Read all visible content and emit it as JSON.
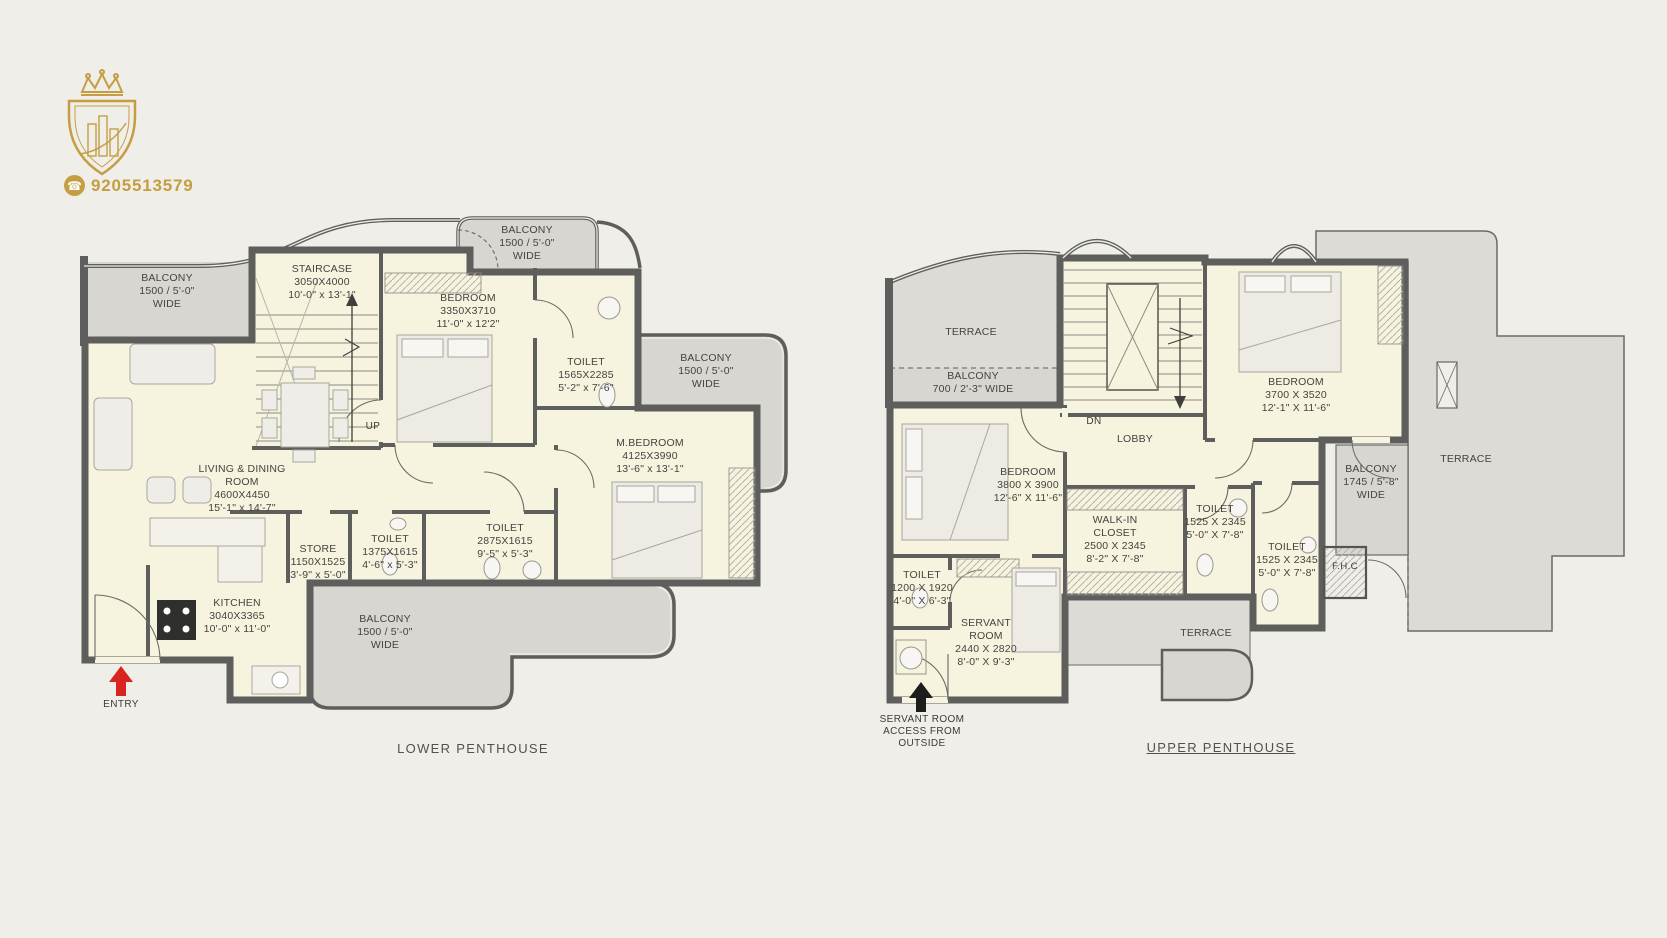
{
  "brand": {
    "phone": "9205513579",
    "phone_icon": "☎",
    "logo_name": "gold-crown-shield-buildings",
    "gold": "#c59d43"
  },
  "colors": {
    "background": "#efeee9",
    "room_fill": "#f6f3df",
    "balcony_fill": "#d7d6d1",
    "terrace_fill": "#dcdbd6",
    "wall": "#5e5e5c",
    "entry_arrow_red": "#d8251f",
    "label_text": "#45443f"
  },
  "lower_penthouse": {
    "title": "LOWER PENTHOUSE",
    "up_label": "UP",
    "entry_label": "ENTRY",
    "rooms": [
      {
        "id": "balcony-top-left",
        "lines": [
          "BALCONY",
          "1500 / 5'-0\"",
          "WIDE"
        ]
      },
      {
        "id": "staircase",
        "lines": [
          "STAIRCASE",
          "3050X4000",
          "10'-0\" x 13'-1\""
        ]
      },
      {
        "id": "bedroom",
        "lines": [
          "BEDROOM",
          "3350X3710",
          "11'-0\" x 12'2\""
        ]
      },
      {
        "id": "balcony-top",
        "lines": [
          "BALCONY",
          "1500 / 5'-0\"",
          "WIDE"
        ]
      },
      {
        "id": "toilet-1",
        "lines": [
          "TOILET",
          "1565X2285",
          "5'-2\" x 7'-6\""
        ]
      },
      {
        "id": "balcony-right",
        "lines": [
          "BALCONY",
          "1500 / 5'-0\"",
          "WIDE"
        ]
      },
      {
        "id": "master-bedroom",
        "lines": [
          "M.BEDROOM",
          "4125X3990",
          "13'-6\" x 13'-1\""
        ]
      },
      {
        "id": "living-dining",
        "lines": [
          "LIVING & DINING",
          "ROOM",
          "4600X4450",
          "15'-1\" x 14'-7\""
        ]
      },
      {
        "id": "store",
        "lines": [
          "STORE",
          "1150X1525",
          "3'-9\" x 5'-0\""
        ]
      },
      {
        "id": "toilet-2",
        "lines": [
          "TOILET",
          "1375X1615",
          "4'-6\" x 5'-3\""
        ]
      },
      {
        "id": "toilet-3",
        "lines": [
          "TOILET",
          "2875X1615",
          "9'-5\" x 5'-3\""
        ]
      },
      {
        "id": "kitchen",
        "lines": [
          "KITCHEN",
          "3040X3365",
          "10'-0\" x 11'-0\""
        ]
      },
      {
        "id": "balcony-bottom",
        "lines": [
          "BALCONY",
          "1500 / 5'-0\"",
          "WIDE"
        ]
      }
    ]
  },
  "upper_penthouse": {
    "title": "UPPER PENTHOUSE",
    "dn_label": "DN",
    "fhc_label": "F.H.C",
    "access_note": [
      "SERVANT ROOM",
      "ACCESS FROM",
      "OUTSIDE"
    ],
    "rooms": [
      {
        "id": "terrace-top-left",
        "lines": [
          "TERRACE"
        ]
      },
      {
        "id": "balcony-top",
        "lines": [
          "BALCONY",
          "700 / 2'-3\" WIDE"
        ]
      },
      {
        "id": "lobby",
        "lines": [
          "LOBBY"
        ]
      },
      {
        "id": "bedroom-right",
        "lines": [
          "BEDROOM",
          "3700 X 3520",
          "12'-1\" X 11'-6\""
        ]
      },
      {
        "id": "terrace-right",
        "lines": [
          "TERRACE"
        ]
      },
      {
        "id": "balcony-right",
        "lines": [
          "BALCONY",
          "1745 / 5'-8\"",
          "WIDE"
        ]
      },
      {
        "id": "bedroom-left",
        "lines": [
          "BEDROOM",
          "3800 X 3900",
          "12'-6\" X 11'-6\""
        ]
      },
      {
        "id": "walk-in-closet",
        "lines": [
          "WALK-IN",
          "CLOSET",
          "2500 X 2345",
          "8'-2\" X 7'-8\""
        ]
      },
      {
        "id": "toilet-1",
        "lines": [
          "TOILET",
          "1525 X 2345",
          "5'-0\" X 7'-8\""
        ]
      },
      {
        "id": "toilet-2",
        "lines": [
          "TOILET",
          "1525 X 2345",
          "5'-0\" X 7'-8\""
        ]
      },
      {
        "id": "toilet-3",
        "lines": [
          "TOILET",
          "1200 X 1920",
          "4'-0\" X 6'-3\""
        ]
      },
      {
        "id": "servant-room",
        "lines": [
          "SERVANT",
          "ROOM",
          "2440 X 2820",
          "8'-0\" X 9'-3\""
        ]
      },
      {
        "id": "terrace-bottom",
        "lines": [
          "TERRACE"
        ]
      }
    ]
  }
}
